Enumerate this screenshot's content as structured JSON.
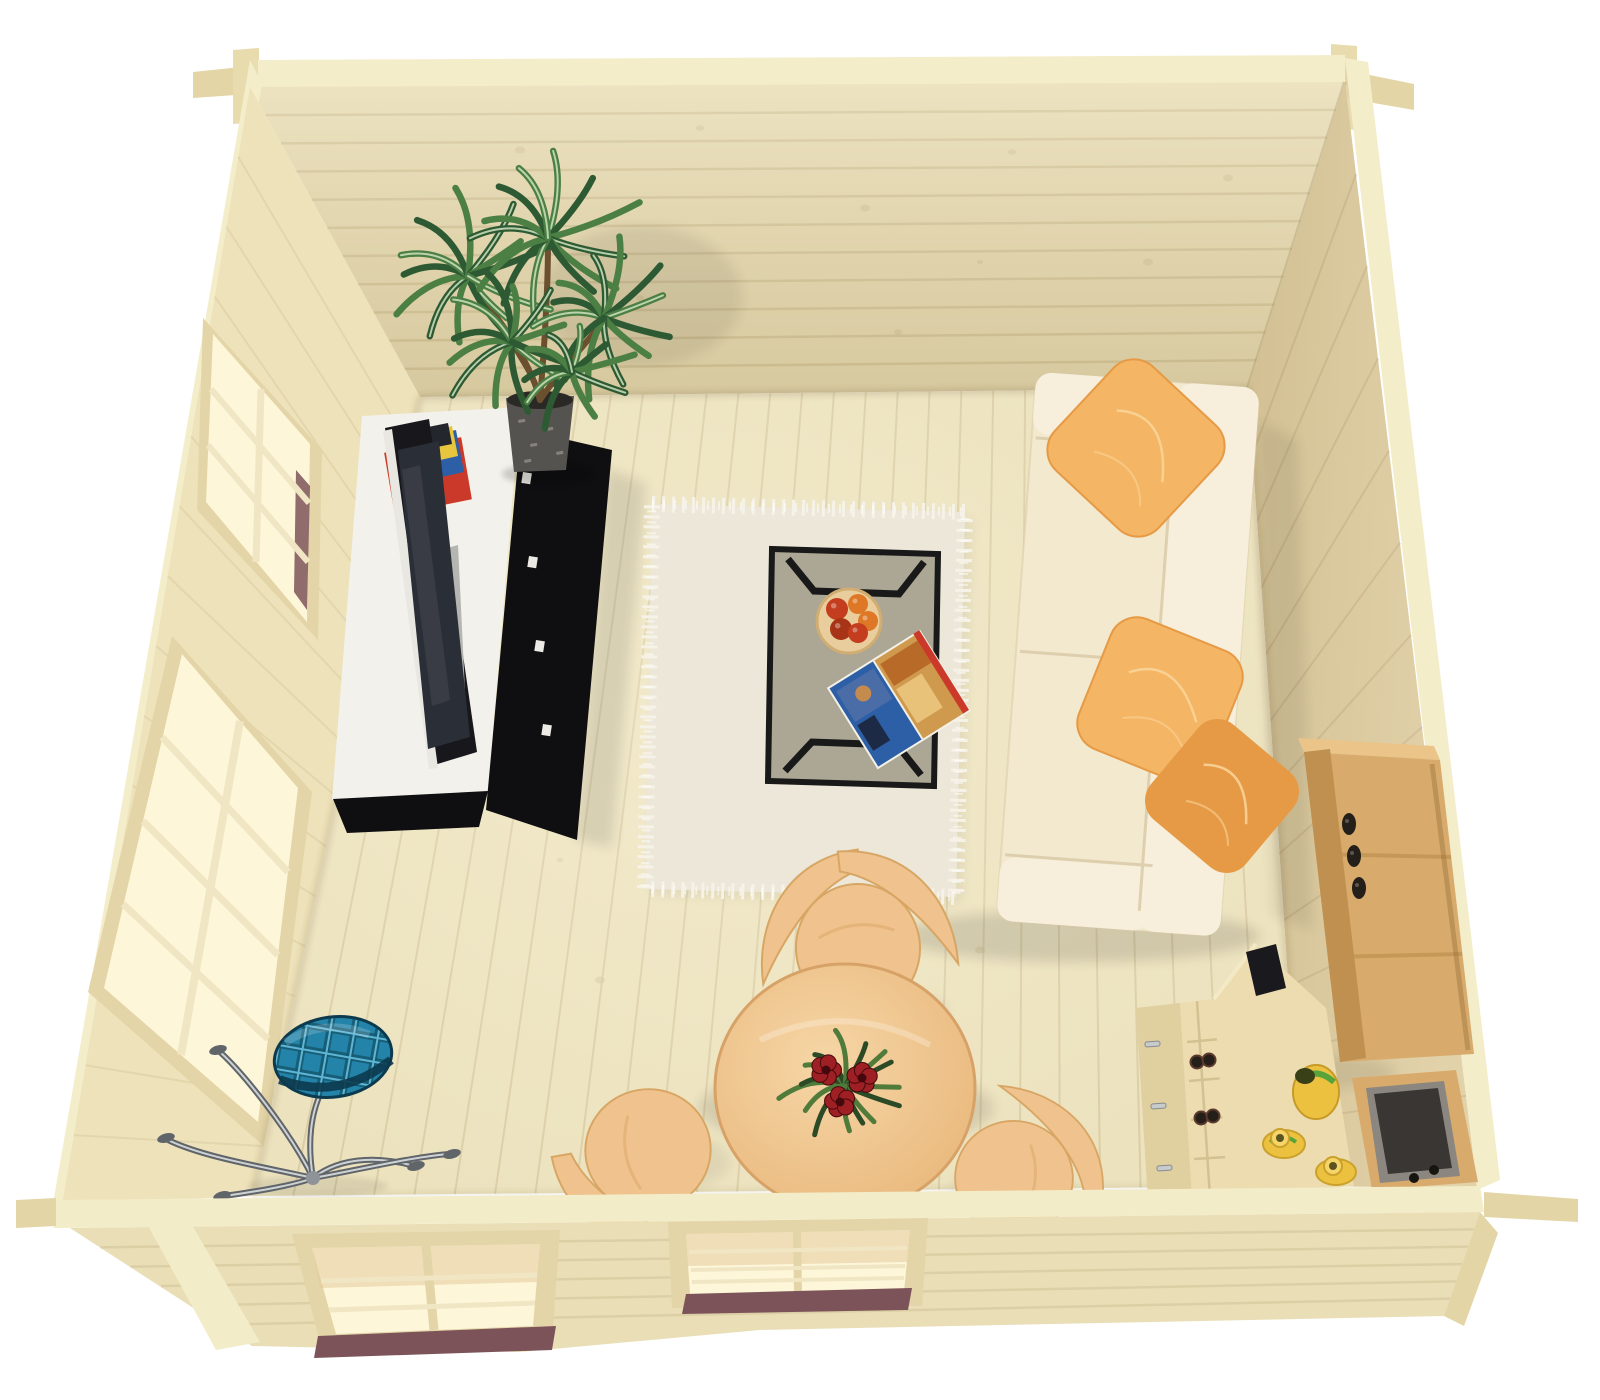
{
  "scene": {
    "kind": "3d-architectural-render",
    "subject": "log cabin interior viewed from directly above (bird's-eye cutaway)",
    "width": 1600,
    "height": 1400,
    "background": "#ffffff"
  },
  "inventory": [
    "far-wall",
    "left-wall",
    "right-wall",
    "front-wall",
    "floor",
    "window-left-upper",
    "window-left-lower",
    "front-window-left",
    "front-window-right",
    "potted-plant",
    "tv-unit",
    "flat-tv",
    "magazines",
    "shag-rug",
    "coffee-table",
    "fruit-bowl",
    "open-magazine",
    "sofa",
    "sofa-pillows",
    "oak-shelf",
    "storage-bin",
    "desk",
    "wine-rack",
    "tea-set",
    "dining-table",
    "dining-chairs",
    "flower-centerpiece",
    "floor-lamp"
  ],
  "palette": {
    "bg": "#ffffff",
    "wood_band": "#f4edca",
    "beam_side": "#e3d5a6",
    "post": "#e8dbae",
    "far_wall": "#e9dcb2",
    "far_line": "#d2c194",
    "left_wall": "#eee2ba",
    "left_line": "#d9cba0",
    "right_wall": "#dfcda0",
    "right_line": "#c7b286",
    "floor": "#ece2be",
    "floor_line": "#d2c49a",
    "front_wall": "#e9deb6",
    "front_line": "#d5c69a",
    "front_band": "#f3ecc8",
    "sill": "#7c5359",
    "window_frame": "#e3d5a7",
    "muntin": "#f0e6c4",
    "glow": "#fdf6d8",
    "glow_warm": "#e6cb9e",
    "trim_dark": "#c9b684",
    "pot": "#555350",
    "pot_light": "#94928a",
    "soil": "#2b2925",
    "leaf_dark": "#2d5a33",
    "leaf_mid": "#4c7f44",
    "leaf_light": "#cfe3c0",
    "trunk": "#6b4f2e",
    "stand_white": "#f2f1ec",
    "stand_shade": "#d8d7d0",
    "panel_black": "#0f0f12",
    "tv_frame": "#17171c",
    "tv_screen": "#2a2e36",
    "tv_edge": "#e9e7e1",
    "speaker": "#b5b6b1",
    "mag_red": "#cb392a",
    "mag_blue": "#2d5fa6",
    "mag_yellow": "#e7c63e",
    "mag_dark": "#23262d",
    "paper": "#f3f1e8",
    "rug": "#ece7d8",
    "rug_fuzz": "#f6f2e7",
    "glass": "#6b654f",
    "frame_black": "#191919",
    "bowl": "#e9cd9c",
    "bowl_rim": "#d0ad72",
    "fruit_red": "#c33d1e",
    "fruit_orange": "#de7826",
    "fruit_deep": "#a83417",
    "sofa": "#f2e9cf",
    "sofa_light": "#f7efdc",
    "sofa_seam": "#d9c9a6",
    "pillow": "#f4b564",
    "pillow_deep": "#e69a45",
    "pillow_line": "#fad498",
    "oak": "#d8ab6d",
    "oak_dark": "#bf9050",
    "oak_light": "#eac488",
    "bottle": "#251f19",
    "bin": "#8b8680",
    "bin_dark": "#393633",
    "desk": "#ecdcb0",
    "desk_side": "#e0cf9f",
    "desk_edge": "#f4e9c6",
    "silver": "#c8cbcc",
    "tea_yellow": "#edc140",
    "tea_green": "#58a43b",
    "tea_dark": "#394018",
    "table_hi": "#f6d6a6",
    "table_lo": "#e9b87c",
    "table_edge": "#d7a267",
    "chair": "#f0c28e",
    "chair_shade": "#d8a664",
    "cflower": "#9e2024",
    "cflower_dark": "#45090d",
    "cleaf_dark": "#2c4a26",
    "cleaf_mid": "#507b3a",
    "chrome": "#8e9397",
    "chrome_light": "#ced2d4",
    "chrome_dark": "#60656a",
    "teal": "#2383a9",
    "teal_dark": "#14586f",
    "teal_deep": "#0c3a4e",
    "teal_light": "#5fb5d5"
  },
  "procedural": {
    "planks": [
      {
        "target": "g-far-planks",
        "a": [
          250,
          87,
          420,
          397
        ],
        "b": [
          1345,
          82,
          1248,
          388
        ],
        "count": 11,
        "color": "far_line",
        "w": 2.5,
        "o": 0.7
      },
      {
        "target": "g-left-planks",
        "a": [
          250,
          87,
          62,
          1205
        ],
        "b": [
          420,
          397,
          253,
          1196
        ],
        "count": 16,
        "color": "left_line",
        "w": 2,
        "o": 0.5
      },
      {
        "target": "g-right-planks",
        "a": [
          1345,
          82,
          1477,
          1188
        ],
        "b": [
          1248,
          388,
          1302,
          1186
        ],
        "count": 12,
        "color": "right_line",
        "w": 2,
        "o": 0.6
      },
      {
        "target": "g-floor-planks",
        "a": [
          420,
          397,
          1248,
          388
        ],
        "b": [
          253,
          1196,
          1302,
          1186
        ],
        "count": 26,
        "color": "floor_line",
        "w": 2,
        "o": 0.65
      },
      {
        "target": "g-front-planks",
        "a": [
          70,
          1228,
          252,
          1344
        ],
        "b": [
          1480,
          1212,
          1444,
          1316
        ],
        "count": 6,
        "color": "front_line",
        "w": 2.5,
        "o": 0.6
      }
    ],
    "far_knots": [
      [
        520,
        150,
        5
      ],
      [
        700,
        128,
        4
      ],
      [
        865,
        208,
        5
      ],
      [
        1012,
        152,
        4
      ],
      [
        1148,
        262,
        5
      ],
      [
        640,
        298,
        4
      ],
      [
        898,
        332,
        4
      ],
      [
        1228,
        178,
        5
      ],
      [
        980,
        262,
        3
      ],
      [
        560,
        240,
        3
      ]
    ],
    "floor_knots": [
      [
        520,
        620,
        4
      ],
      [
        600,
        980,
        5
      ],
      [
        760,
        1080,
        4
      ],
      [
        1060,
        560,
        4
      ],
      [
        980,
        950,
        5
      ],
      [
        680,
        760,
        3
      ],
      [
        480,
        520,
        3
      ],
      [
        1120,
        760,
        4
      ],
      [
        900,
        1120,
        4
      ],
      [
        560,
        860,
        3
      ]
    ],
    "plant_rosettes": [
      {
        "cx": 468,
        "cy": 276,
        "n": 13,
        "len": 80,
        "seed": 1
      },
      {
        "cx": 548,
        "cy": 238,
        "n": 13,
        "len": 84,
        "seed": 7
      },
      {
        "cx": 604,
        "cy": 318,
        "n": 12,
        "len": 74,
        "seed": 13
      },
      {
        "cx": 512,
        "cy": 342,
        "n": 12,
        "len": 70,
        "seed": 19
      },
      {
        "cx": 572,
        "cy": 372,
        "n": 10,
        "len": 58,
        "seed": 25
      }
    ],
    "centerpiece": {
      "cx": 845,
      "cy": 1086,
      "n": 15,
      "len": 60,
      "seed": 31
    },
    "centerpiece_flowers": [
      [
        826,
        1070
      ],
      [
        862,
        1078
      ],
      [
        840,
        1102
      ]
    ],
    "chairs": [
      {
        "x": 858,
        "y": 948,
        "rot": -6,
        "s": 1.0,
        "wings": 2
      },
      {
        "x": 648,
        "y": 1150,
        "rot": -100,
        "s": 0.98,
        "wings": 1
      },
      {
        "x": 1014,
        "y": 1178,
        "rot": 96,
        "s": 0.92,
        "wings": 1
      }
    ],
    "pillows": [
      {
        "x": 1136,
        "y": 448,
        "s": 142,
        "rot": 43,
        "deep": false
      },
      {
        "x": 1160,
        "y": 700,
        "s": 140,
        "rot": 22,
        "deep": false
      },
      {
        "x": 1222,
        "y": 796,
        "s": 122,
        "rot": 40,
        "deep": true
      }
    ],
    "lamp": {
      "hub": [
        313,
        1178
      ],
      "arms": [
        {
          "d": "M313,1178 C270,1168 205,1158 168,1140",
          "tip": [
            166,
            1138
          ]
        },
        {
          "d": "M313,1178 C288,1128 242,1072 220,1052",
          "tip": [
            218,
            1050
          ]
        },
        {
          "d": "M313,1178 C306,1136 312,1098 334,1072",
          "tip": null
        },
        {
          "d": "M313,1178 C344,1154 386,1158 414,1166",
          "tip": [
            416,
            1166
          ]
        },
        {
          "d": "M313,1178 C348,1172 416,1156 450,1154",
          "tip": [
            452,
            1154
          ]
        },
        {
          "d": "M313,1178 C292,1186 252,1192 224,1196",
          "tip": [
            222,
            1196
          ]
        }
      ]
    },
    "fruits": [
      [
        837,
        609,
        11,
        "fruit_red"
      ],
      [
        858,
        604,
        10,
        "fruit_orange"
      ],
      [
        868,
        621,
        10,
        "fruit_orange"
      ],
      [
        841,
        629,
        11,
        "fruit_deep"
      ],
      [
        858,
        633,
        10,
        "fruit_red"
      ]
    ],
    "shelf_bottles": [
      [
        1349,
        824
      ],
      [
        1354,
        856
      ],
      [
        1359,
        888
      ]
    ],
    "rack_bottles": [
      [
        1197,
        1062
      ],
      [
        1209,
        1060
      ],
      [
        1201,
        1118
      ],
      [
        1213,
        1116
      ]
    ],
    "desk_handles": [
      [
        1152,
        1044
      ],
      [
        1158,
        1106
      ],
      [
        1164,
        1168
      ]
    ],
    "panel_clips": [
      [
        523,
        472
      ],
      [
        529,
        556
      ],
      [
        536,
        640
      ],
      [
        543,
        724
      ]
    ],
    "pot_speckles": [
      [
        518,
        420
      ],
      [
        530,
        444
      ],
      [
        546,
        428
      ],
      [
        556,
        452
      ],
      [
        524,
        460
      ]
    ]
  }
}
